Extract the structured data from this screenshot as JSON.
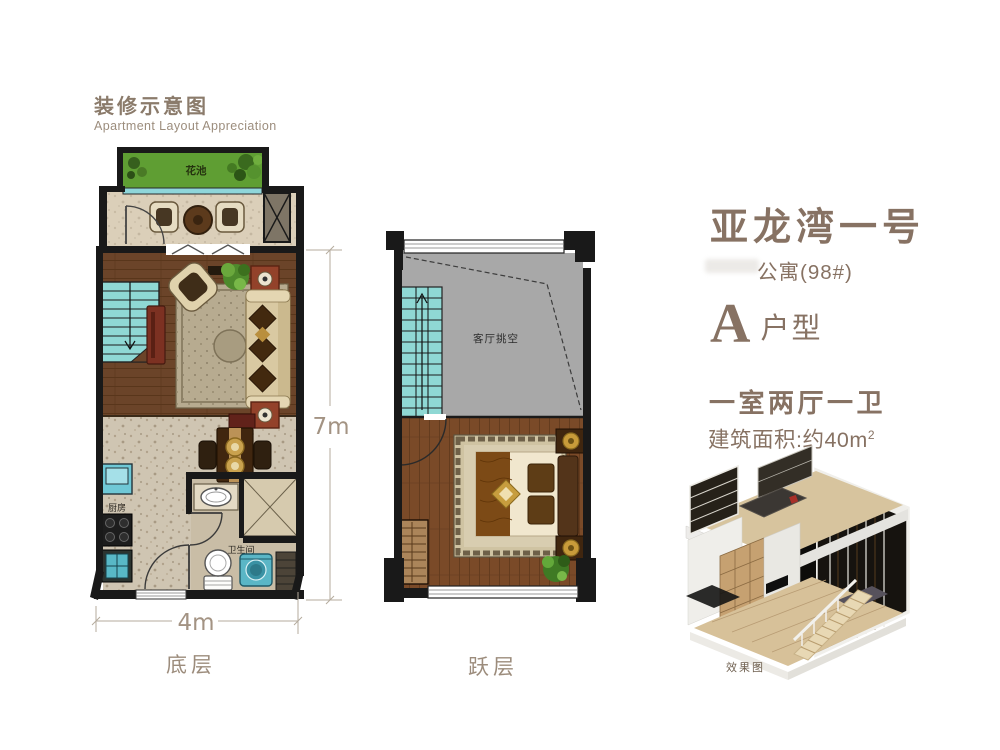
{
  "header": {
    "title": "装修示意图",
    "subtitle": "Apartment Layout Appreciation"
  },
  "info": {
    "project_title": "亚龙湾一号",
    "building": "公寓(98#)",
    "unit_letter": "A",
    "unit_suffix": "户型",
    "layout": "一室两厅一卫",
    "area_prefix": "建筑面积:约40m",
    "area_sup": "2"
  },
  "plans": {
    "ground": {
      "caption": "底层",
      "labels": {
        "flower_bed": "花池",
        "kitchen": "厨房",
        "bathroom": "卫生间"
      },
      "dimensions": {
        "width": "4m",
        "depth": "7m"
      }
    },
    "upper": {
      "caption": "跃层",
      "labels": {
        "void": "客厅挑空"
      }
    }
  },
  "render": {
    "caption": "效果图"
  },
  "colors": {
    "accent_text": "#877263",
    "caption_text": "#9c8c7c",
    "wall": "#191919",
    "stairs_teal": "#8fd8d4",
    "void_gray": "#a8a8a8",
    "living_wood": "#6b4429",
    "bedroom_wood": "#7a4a28",
    "flower_green": "#5f9e33",
    "tile": "#cfc5b2"
  }
}
